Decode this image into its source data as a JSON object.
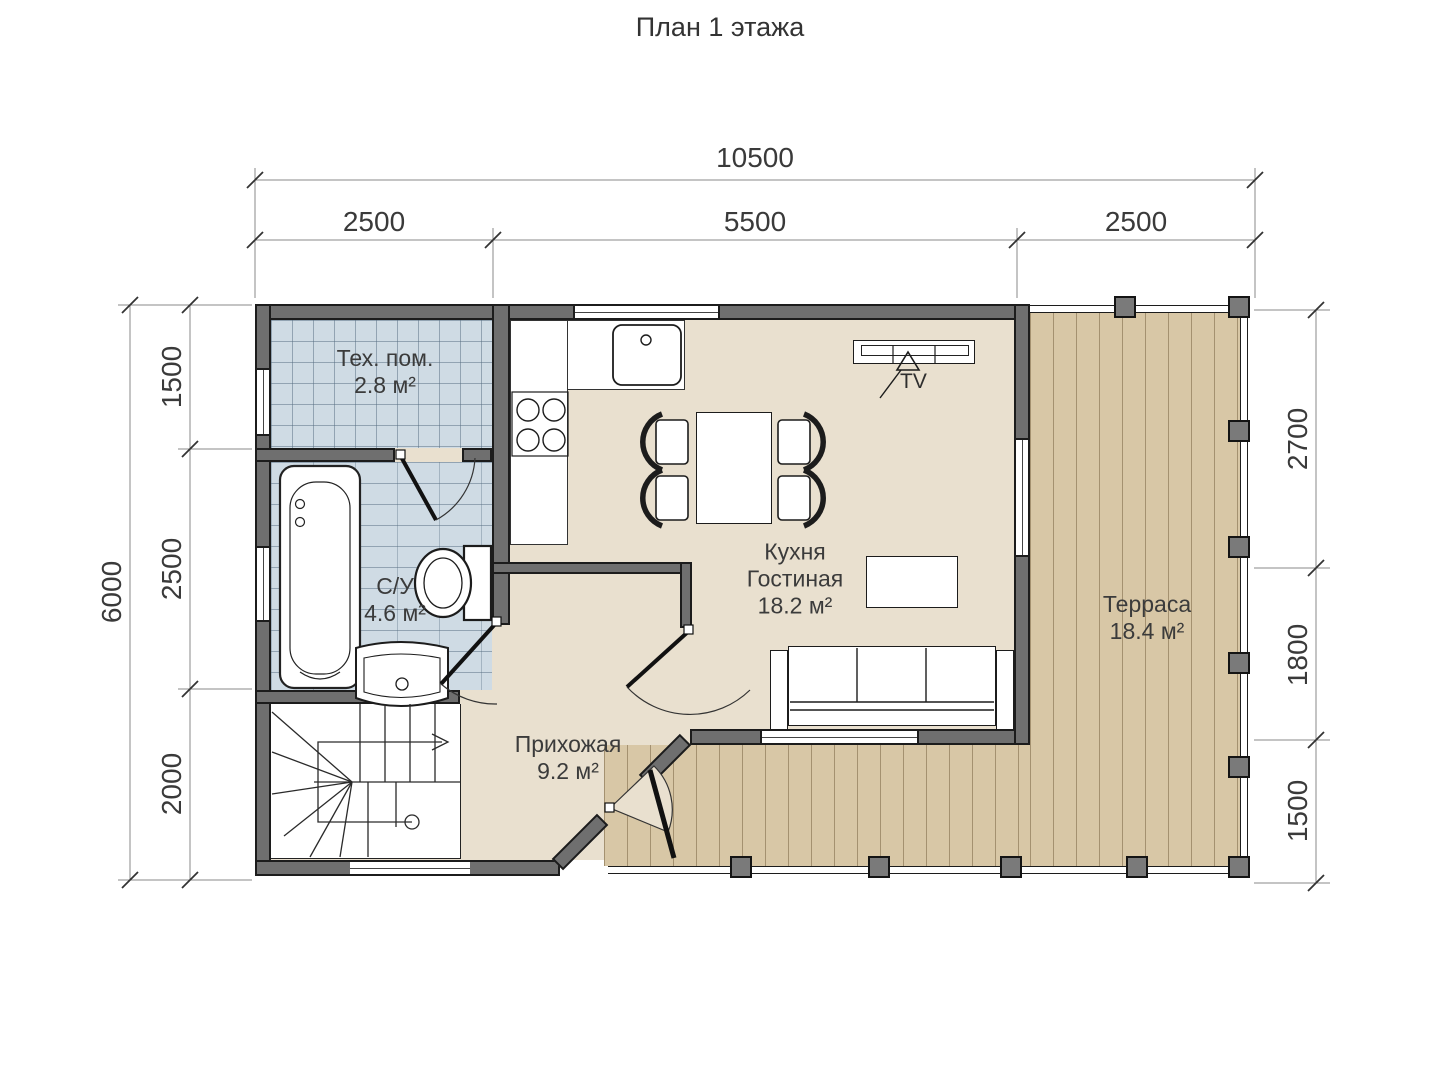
{
  "title": "План 1 этажа",
  "dims": {
    "top": {
      "total": "10500",
      "seg1": "2500",
      "seg2": "5500",
      "seg3": "2500"
    },
    "left": {
      "total": "6000",
      "seg1": "1500",
      "seg2": "2500",
      "seg3": "2000"
    },
    "right": {
      "seg1": "2700",
      "seg2": "1800",
      "seg3": "1500"
    }
  },
  "rooms": {
    "tech": {
      "name": "Тех. пом.",
      "area": "2.8 м²"
    },
    "bath": {
      "name": "С/У",
      "area": "4.6 м²"
    },
    "kitchen": {
      "line1": "Кухня",
      "line2": "Гостиная",
      "area": "18.2 м²"
    },
    "hall": {
      "name": "Прихожая",
      "area": "9.2 м²"
    },
    "terrace": {
      "name": "Терраса",
      "area": "18.4 м²"
    }
  },
  "labels": {
    "tv": "TV"
  },
  "colors": {
    "wall": "#6f6f6f",
    "floor": "#e9e0cf",
    "terrace": "#d8c7a6",
    "tile": "#cfdbe4",
    "outline": "#1c1c1c"
  }
}
